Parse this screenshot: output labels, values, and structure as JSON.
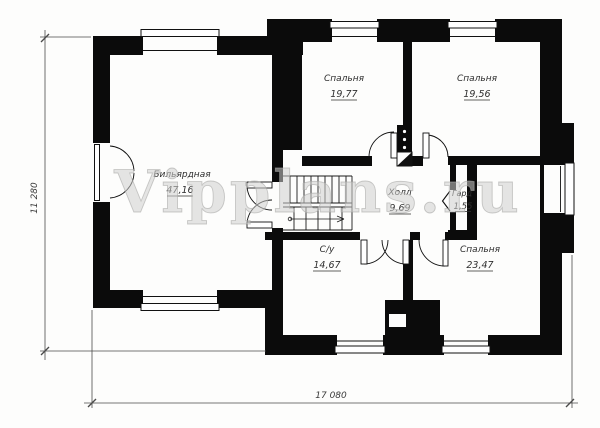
{
  "watermark": {
    "text": "Vipplans.ru"
  },
  "dimensions": {
    "height_mm": "11 280",
    "width_mm": "17 080"
  },
  "rooms": [
    {
      "name": "Бильярдная",
      "area": "47,16"
    },
    {
      "name": "Спальня",
      "area": "19,77"
    },
    {
      "name": "Спальня",
      "area": "19,56"
    },
    {
      "name": "Холл",
      "area": "9,69"
    },
    {
      "name": "Гард",
      "area": "1,55"
    },
    {
      "name": "С/у",
      "area": "14,67"
    },
    {
      "name": "Спальня",
      "area": "23,47"
    }
  ]
}
